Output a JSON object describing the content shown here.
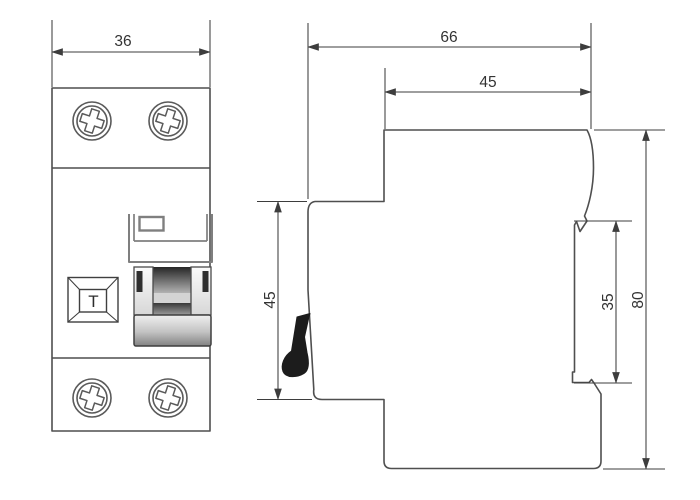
{
  "drawing": {
    "front_view": {
      "width_label": "36",
      "test_button_label": "T"
    },
    "side_view": {
      "depth_label": "66",
      "upper_depth_label": "45",
      "front_height_label": "45",
      "recess_height_label": "35",
      "height_label": "80"
    },
    "colors": {
      "outline": "#4f4f4f",
      "dimension_line": "#3d3d3d",
      "text": "#333333",
      "lever": "#1c1c1c",
      "background": "#ffffff"
    }
  }
}
